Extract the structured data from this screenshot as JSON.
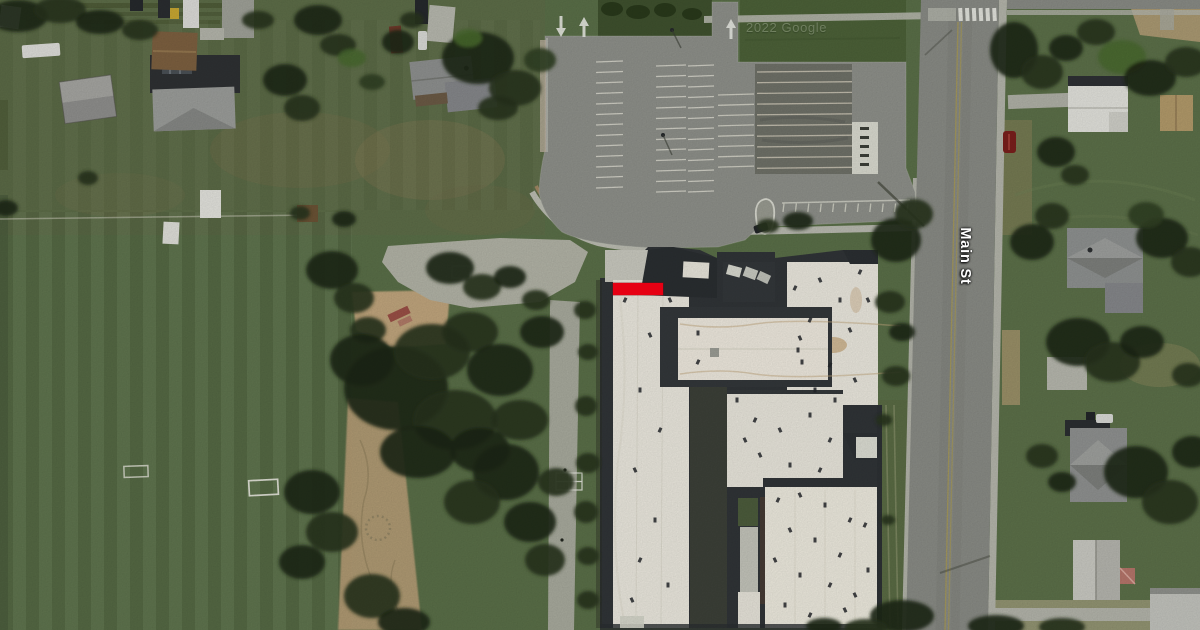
{
  "map": {
    "street_label": "Main St",
    "watermark": "2022 Google",
    "palette": {
      "marker": "#e60013",
      "grass": "#5a6f48",
      "grass_dark": "#3f512e",
      "asphalt": "#8e908a",
      "asphalt_dark": "#6f7168",
      "road": "#898b85",
      "concrete": "#b6b7ac",
      "roof_light": "#ebe8de",
      "roof_dark": "#303437",
      "tree": "#26331c",
      "sand": "#c0a57d",
      "line_white": "#dcdbd0",
      "line_yellow": "#a89a55"
    }
  }
}
